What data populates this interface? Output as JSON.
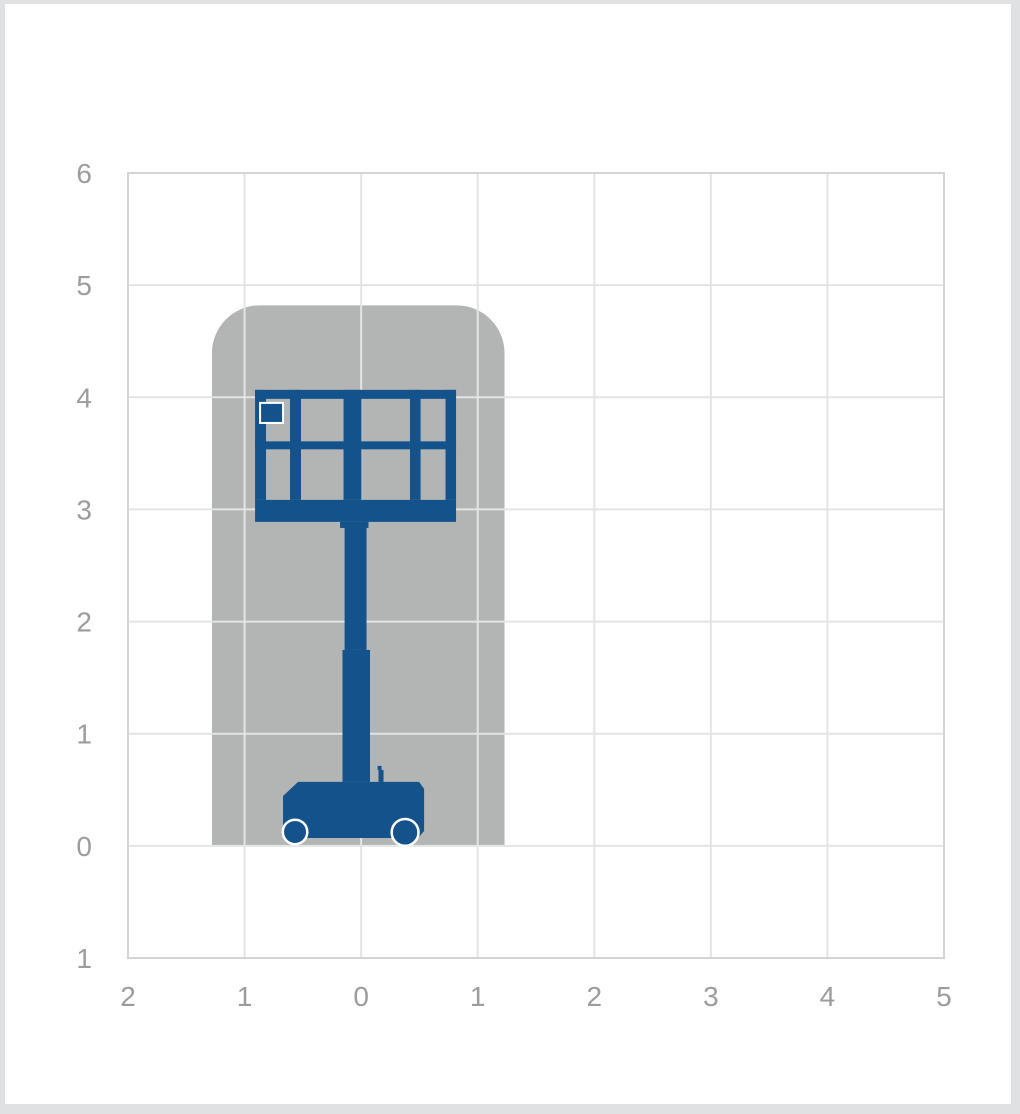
{
  "page": {
    "background": "#ffffff",
    "frame_color": "#e0e1e3"
  },
  "chart_data": {
    "type": "area",
    "title": "Vertical mast lift working envelope",
    "grid": {
      "show": true,
      "color": "#e2e4e6",
      "border_color": "#d2d4d6"
    },
    "tick_label_color": "#9a9c9e",
    "x_axis": {
      "min": -2,
      "max": 5,
      "tick_step": 1,
      "tick_labels": [
        "2",
        "1",
        "0",
        "1",
        "2",
        "3",
        "4",
        "5"
      ]
    },
    "y_axis": {
      "min": -1,
      "max": 6,
      "tick_step": 1,
      "tick_labels": [
        "1",
        "0",
        "1",
        "2",
        "3",
        "4",
        "5",
        "6"
      ]
    },
    "series": [
      {
        "name": "working-envelope",
        "type": "filled-region",
        "color": "#b3b4b4",
        "x_min": -1.28,
        "x_max": 1.23,
        "y_min": 0,
        "y_max": 4.82,
        "corner_radius_top": 0.41
      }
    ],
    "machine": {
      "name": "vertical-mast-lift-silhouette",
      "color": "#14528c",
      "outline_color": "#ffffff",
      "rects": [
        {
          "name": "platform-top-rail",
          "x1": -0.91,
          "y1": 4.066,
          "x2": 0.814,
          "y2": 3.986
        },
        {
          "name": "platform-left-post",
          "x1": -0.91,
          "y1": 4.066,
          "x2": -0.816,
          "y2": 3.085
        },
        {
          "name": "platform-divider-left",
          "x1": -0.61,
          "y1": 4.066,
          "x2": -0.516,
          "y2": 3.085
        },
        {
          "name": "mast-in-platform",
          "x1": -0.151,
          "y1": 4.066,
          "x2": 0.003,
          "y2": 3.085
        },
        {
          "name": "platform-divider-right",
          "x1": 0.419,
          "y1": 4.066,
          "x2": 0.51,
          "y2": 3.085
        },
        {
          "name": "platform-right-post",
          "x1": 0.724,
          "y1": 4.066,
          "x2": 0.814,
          "y2": 3.085
        },
        {
          "name": "platform-mid-rail",
          "x1": -0.91,
          "y1": 3.607,
          "x2": 0.814,
          "y2": 3.536
        },
        {
          "name": "platform-floor",
          "x1": -0.91,
          "y1": 3.085,
          "x2": 0.814,
          "y2": 2.889
        },
        {
          "name": "mast-shoulder",
          "x1": -0.181,
          "y1": 2.889,
          "x2": 0.063,
          "y2": 2.835
        },
        {
          "name": "mast-upper",
          "x1": -0.142,
          "y1": 2.889,
          "x2": 0.046,
          "y2": 1.747
        },
        {
          "name": "mast-lower",
          "x1": -0.16,
          "y1": 1.747,
          "x2": 0.076,
          "y2": 0.57
        },
        {
          "name": "control-lever",
          "x1": 0.149,
          "y1": 0.677,
          "x2": 0.192,
          "y2": 0.57
        },
        {
          "name": "control-lever-knob",
          "x1": 0.141,
          "y1": 0.713,
          "x2": 0.175,
          "y2": 0.677
        }
      ],
      "control_box": {
        "name": "platform-control-box",
        "x1": -0.867,
        "y1": 3.95,
        "x2": -0.67,
        "y2": 3.771
      },
      "chassis_polygon": [
        [
          -0.541,
          0.57
        ],
        [
          0.497,
          0.57
        ],
        [
          0.54,
          0.508
        ],
        [
          0.54,
          0.133
        ],
        [
          0.488,
          0.07
        ],
        [
          -0.627,
          0.07
        ],
        [
          -0.67,
          0.133
        ],
        [
          -0.67,
          0.445
        ]
      ],
      "wheels": [
        {
          "name": "left-wheel",
          "cx": -0.567,
          "cy": 0.124,
          "r": 0.105
        },
        {
          "name": "right-wheel",
          "cx": 0.377,
          "cy": 0.12,
          "r": 0.115
        }
      ]
    }
  }
}
